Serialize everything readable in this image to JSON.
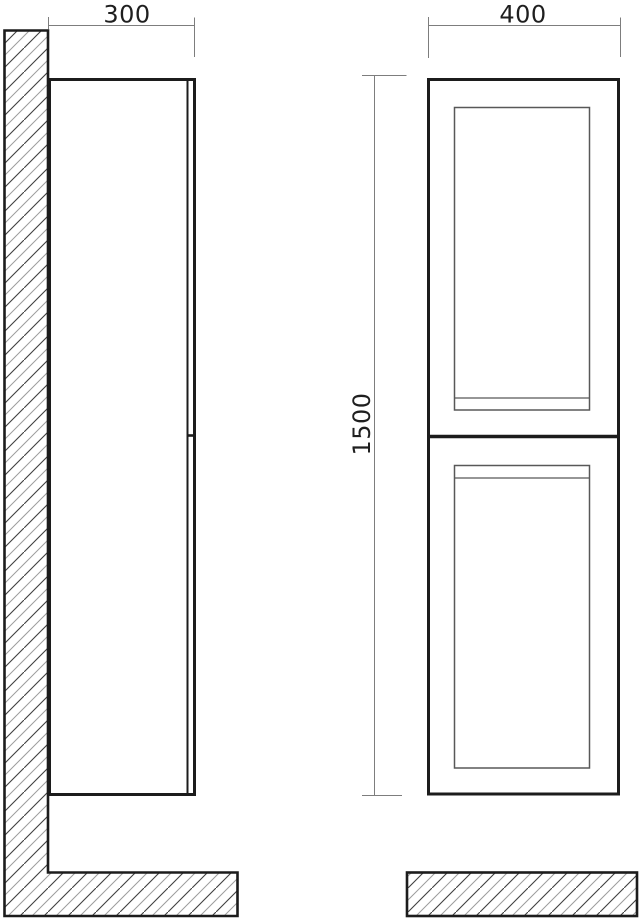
{
  "drawing": {
    "dimension_labels": {
      "depth": "300",
      "width": "400",
      "height": "1500"
    },
    "colors": {
      "background": "#ffffff",
      "outline": "#1c1c1c",
      "panel_line": "#585858",
      "dimension_line": "#7d7d7d",
      "label_text": "#1f1f1f",
      "hatch_dark": "#3f3f3f",
      "hatch_light": "#9c9c9c"
    }
  }
}
